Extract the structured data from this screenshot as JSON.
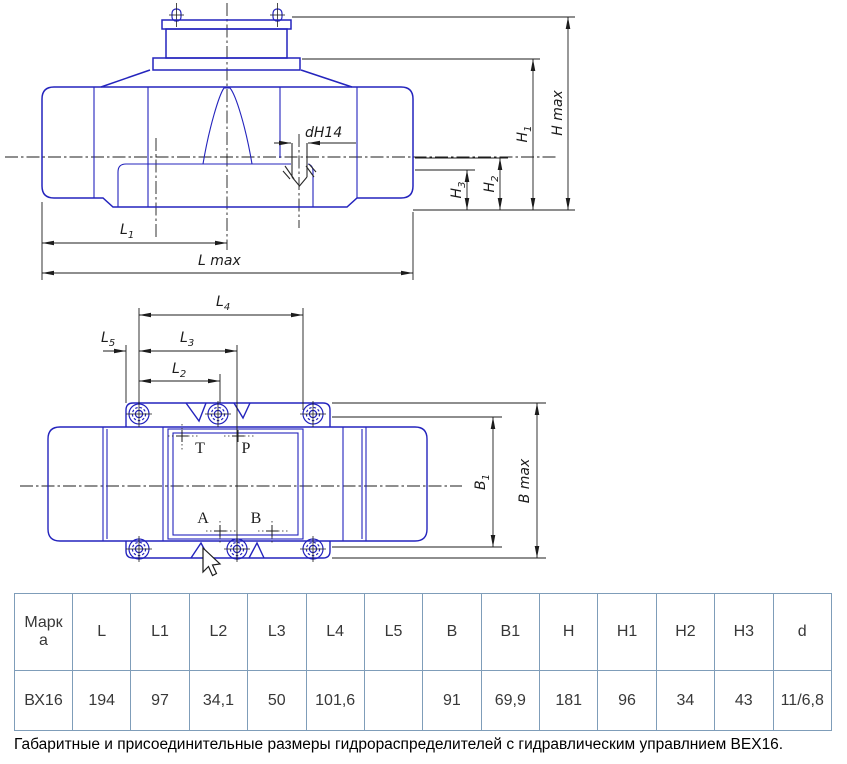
{
  "drawing": {
    "part_color": "#2424bd",
    "dim_color": "#1c1c1c",
    "side_view": {
      "dims": {
        "l1": {
          "main": "L",
          "sub": "1"
        },
        "lmax": {
          "main": "L max",
          "sub": ""
        },
        "dhole": {
          "main": "dH14",
          "sub": ""
        },
        "h3": {
          "main": "H",
          "sub": "3"
        },
        "h2": {
          "main": "H",
          "sub": "2"
        },
        "h1": {
          "main": "H",
          "sub": "1"
        },
        "hmax": {
          "main": "H max",
          "sub": ""
        }
      }
    },
    "plan_view": {
      "dims": {
        "l4": {
          "main": "L",
          "sub": "4"
        },
        "l3": {
          "main": "L",
          "sub": "3"
        },
        "l2": {
          "main": "L",
          "sub": "2"
        },
        "l5": {
          "main": "L",
          "sub": "5"
        },
        "b1": {
          "main": "B",
          "sub": "1"
        },
        "bmax": {
          "main": "B max",
          "sub": ""
        }
      },
      "ports": {
        "t": "T",
        "p": "P",
        "a": "A",
        "b": "B"
      }
    }
  },
  "table": {
    "headers": [
      "Марка",
      "L",
      "L1",
      "L2",
      "L3",
      "L4",
      "L5",
      "B",
      "B1",
      "H",
      "H1",
      "H2",
      "H3",
      "d"
    ],
    "row": [
      "ВХ16",
      "194",
      "97",
      "34,1",
      "50",
      "101,6",
      "",
      "91",
      "69,9",
      "181",
      "96",
      "34",
      "43",
      "11/6,8"
    ]
  },
  "caption": "Габаритные и присоединительные размеры гидрораспределителей с гидравлическим управлнием ВЕХ16."
}
